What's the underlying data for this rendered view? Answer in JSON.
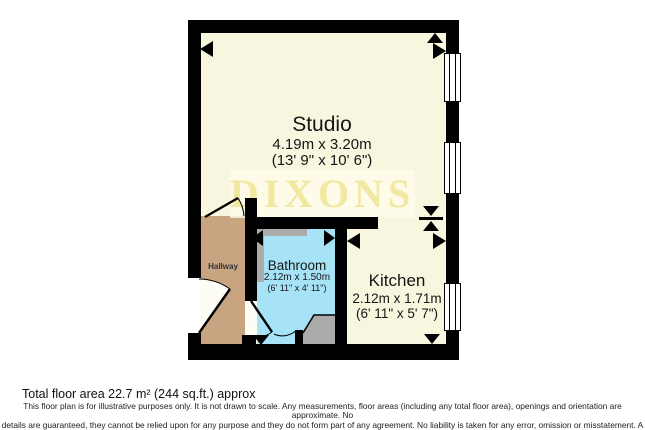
{
  "plan": {
    "watermark": "DIXONS",
    "rooms": {
      "studio": {
        "name": "Studio",
        "metric": "4.19m x 3.20m",
        "imperial": "(13' 9\" x 10' 6\")"
      },
      "bathroom": {
        "name": "Bathroom",
        "metric": "2.12m x 1.50m",
        "imperial": "(6' 11\" x 4' 11\")"
      },
      "kitchen": {
        "name": "Kitchen",
        "metric": "2.12m x 1.71m",
        "imperial": "(6' 11\" x 5' 7\")"
      },
      "hallway": {
        "name": "Hallway"
      }
    },
    "colors": {
      "wall": "#000000",
      "floor_cream": "#F9F6E0",
      "hallway_tan": "#C8A480",
      "bathroom_blue": "#A6E3F7",
      "fixture_gray": "#ABABAB",
      "watermark_yellow": "#F1E8A2"
    }
  },
  "footer": {
    "total_area": "Total floor area 22.7 m² (244 sq.ft.) approx",
    "disclaimer": [
      "This floor plan is for illustrative purposes only. It is not drawn to scale. Any measurements, floor areas (including any total floor area), openings and orientation are approximate. No",
      "details are guaranteed, they cannot be relied upon for any purpose and they do not form part of any agreement. No liability is taken for any error, omission or misstatement. A party",
      "must rely upon its own inspection(s). Powered by www.focalagent.com"
    ]
  }
}
